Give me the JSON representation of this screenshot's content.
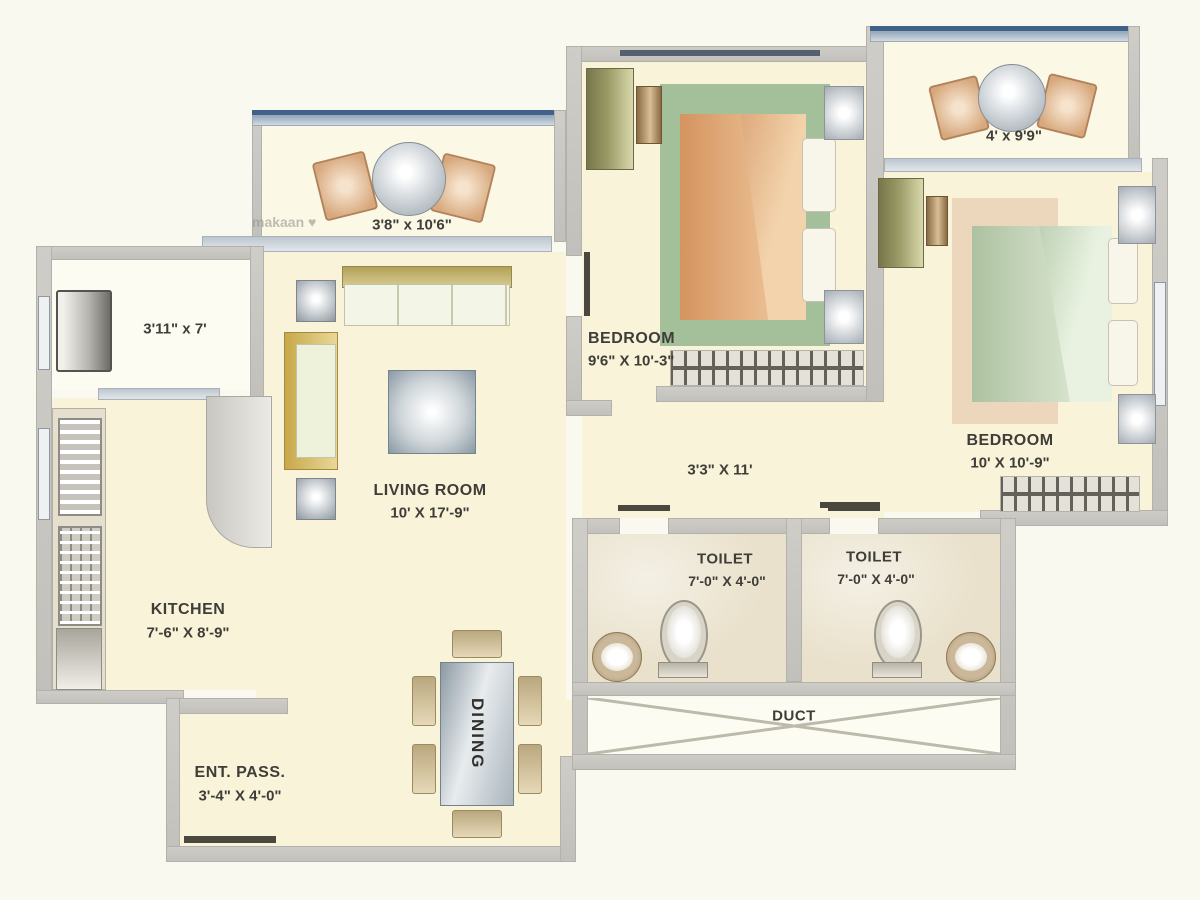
{
  "plan": {
    "watermark": "makaan ♥",
    "rooms": {
      "balcony_top_left": {
        "dim": "3'8\" x 10'6\""
      },
      "balcony_top_right": {
        "dim": "4' x 9'9\""
      },
      "utility": {
        "dim": "3'11\" x 7'"
      },
      "kitchen": {
        "name": "KITCHEN",
        "dim": "7'-6\" X 8'-9\""
      },
      "living_room": {
        "name": "LIVING ROOM",
        "dim": "10' X 17'-9\""
      },
      "bedroom_1": {
        "name": "BEDROOM",
        "dim": "9'6\" X 10'-3\""
      },
      "bedroom_2": {
        "name": "BEDROOM",
        "dim": "10' X 10'-9\""
      },
      "passage": {
        "dim": "3'3\" X 11'"
      },
      "toilet_1": {
        "name": "TOILET",
        "dim": "7'-0\" X 4'-0\""
      },
      "toilet_2": {
        "name": "TOILET",
        "dim": "7'-0\" X 4'-0\""
      },
      "duct": {
        "name": "DUCT"
      },
      "entrance_passage": {
        "name": "ENT. PASS.",
        "dim": "3'-4\" X 4'-0\""
      },
      "dining": {
        "name": "DINING"
      }
    },
    "colors": {
      "floor_cream": "#f8f3d9",
      "wall_gray": "#c9c7c2",
      "window_blue": "#3f618a",
      "bed1_orange": "#dd9c66",
      "bed2_green": "#b5c9a8",
      "rug_green": "#a4c09a",
      "rug_peach": "#ecd7bd",
      "toilet_marble": "#e9e1cb"
    }
  }
}
